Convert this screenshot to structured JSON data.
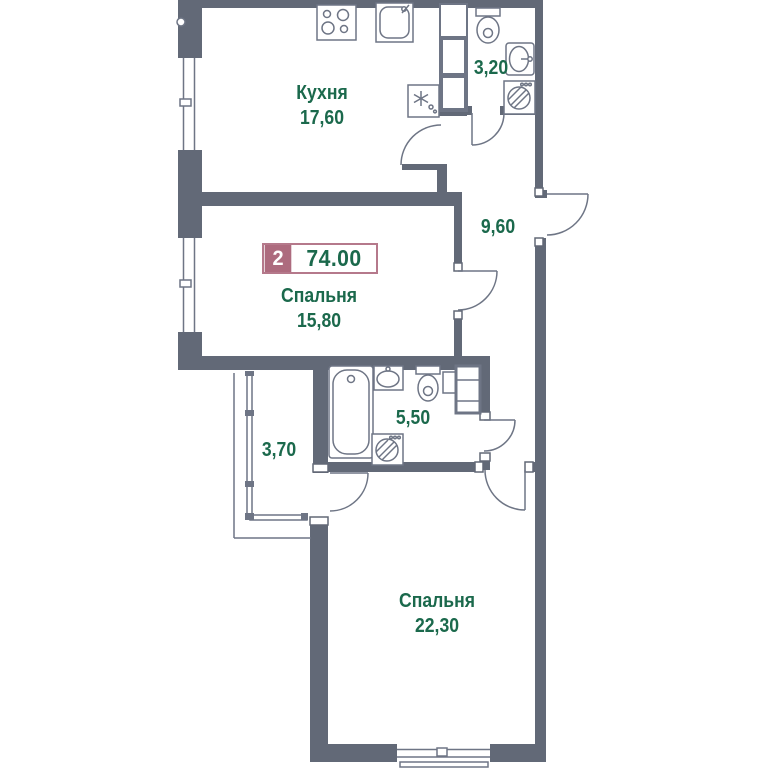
{
  "badge": {
    "rooms_count": "2",
    "total_area": "74.00"
  },
  "rooms": {
    "kitchen": {
      "name": "Кухня",
      "area": "17,60"
    },
    "bathroom_top": {
      "area": "3,20"
    },
    "hallway": {
      "area": "9,60"
    },
    "bedroom_middle": {
      "name": "Спальня",
      "area": "15,80"
    },
    "bathroom_middle": {
      "area": "5,50"
    },
    "balcony": {
      "area": "3,70"
    },
    "bedroom_bottom": {
      "name": "Спальня",
      "area": "22,30"
    }
  },
  "colors": {
    "wall": "#626977",
    "fixture_line": "#6e7585",
    "label_green": "#1b694c",
    "badge_mauve": "#ad6b7e"
  },
  "icons": [
    "stove-icon",
    "kitchen-sink-icon",
    "fridge-icon",
    "wardrobe-icon",
    "toilet-icon",
    "washbasin-icon",
    "washing-machine-icon",
    "bathtub-icon",
    "shelf-icon",
    "window",
    "door-arc"
  ]
}
